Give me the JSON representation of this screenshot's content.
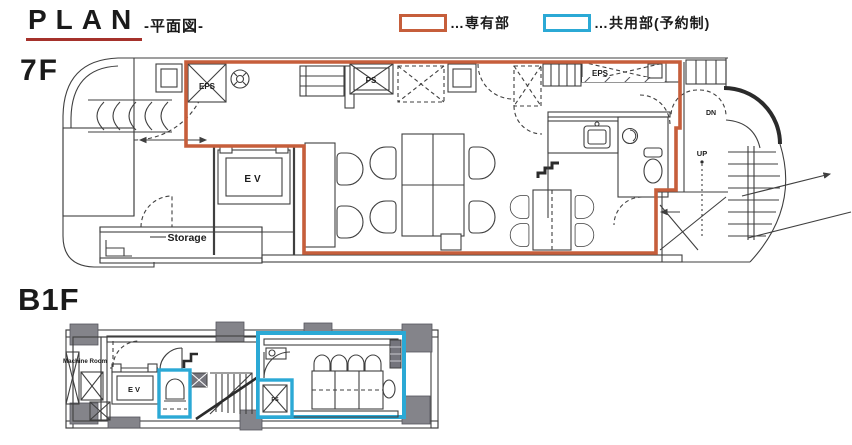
{
  "header": {
    "title": "PLAN",
    "subtitle": "-平面図-",
    "legend": [
      {
        "label": "…専有部",
        "color": "#C65E3B"
      },
      {
        "label": "…共用部(予約制)",
        "color": "#2BA9D5"
      }
    ]
  },
  "colors": {
    "exclusive_outline": "#C65E3B",
    "shared_outline": "#2BA9D5",
    "title_underline": "#A5312B",
    "wall_gray": "#9A9AA0",
    "line": "#3F3F3F"
  },
  "floors": [
    {
      "label": "7F",
      "labels": {
        "eps_left": "EPS",
        "ps": "PS",
        "eps_right": "EPS",
        "ev": "EV",
        "storage": "Storage",
        "up": "UP",
        "dn": "DN"
      }
    },
    {
      "label": "B1F",
      "labels": {
        "machine_room": "Machine Room",
        "ev": "EV",
        "ps": "PS"
      }
    }
  ]
}
